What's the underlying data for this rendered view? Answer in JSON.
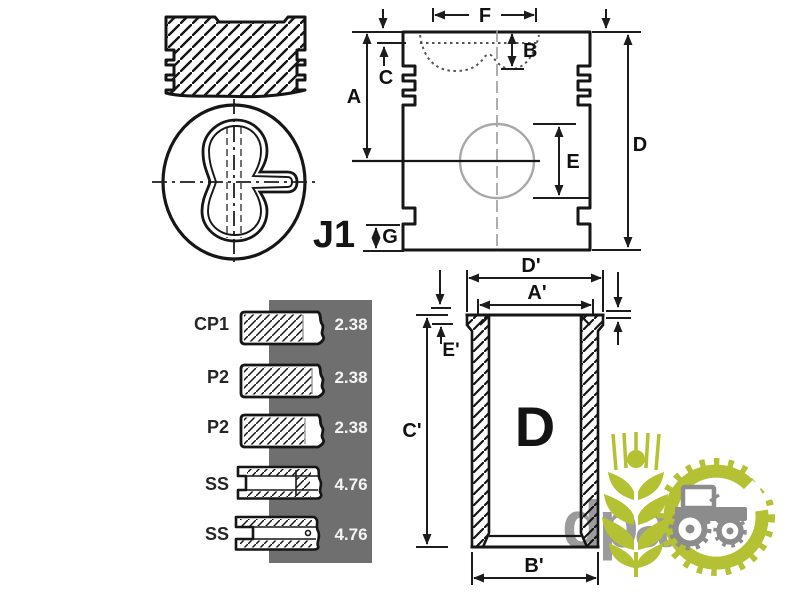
{
  "diagram": {
    "callout": "J1",
    "bore_letter": "D",
    "piston_dims": {
      "f": "F",
      "b": "B",
      "c": "C",
      "a": "A",
      "e": "E",
      "d": "D",
      "g": "G"
    },
    "liner_dims": {
      "d_prime": "D'",
      "a_prime": "A'",
      "e_prime": "E'",
      "c_prime": "C'",
      "b_prime": "B'"
    },
    "rings": [
      {
        "label": "CP1",
        "value": "2.38"
      },
      {
        "label": "P2",
        "value": "2.38"
      },
      {
        "label": "P2",
        "value": "2.38"
      },
      {
        "label": "SS",
        "value": "4.76"
      },
      {
        "label": "SS",
        "value": "4.76"
      }
    ],
    "watermark_text": "dpa",
    "colors": {
      "line": "#161616",
      "ring_panel_gray": "#6f6f6f",
      "logo_green": "#b4c133",
      "logo_gray": "#9b9b9b"
    }
  }
}
